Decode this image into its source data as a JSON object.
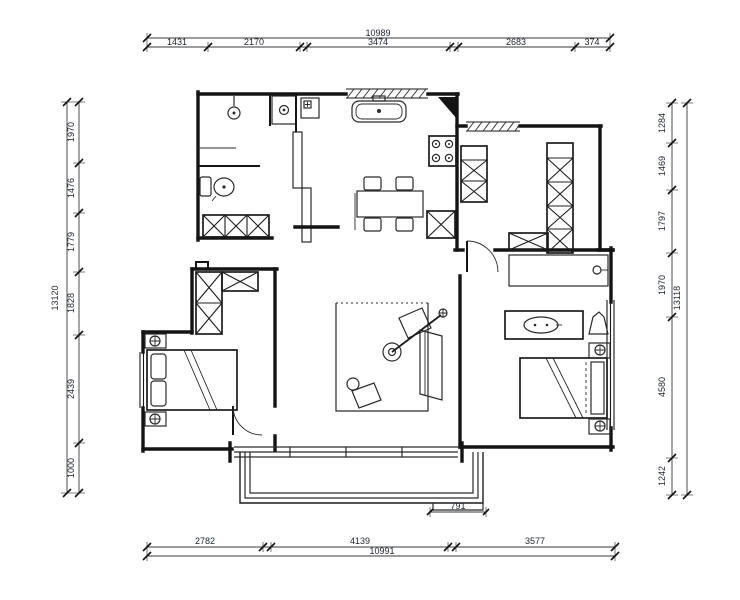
{
  "dimensions": {
    "top": {
      "total": "10989",
      "seg1": "1431",
      "seg2": "2170",
      "seg3": "3474",
      "seg4": "2683",
      "seg5": "374"
    },
    "bottom": {
      "total": "10991",
      "seg1": "2782",
      "seg2": "4139",
      "seg3": "3577"
    },
    "left": {
      "total": "13120",
      "seg1": "1970",
      "seg2": "1476",
      "seg3": "1779",
      "seg4": "1828",
      "seg5": "2439",
      "seg6": "1000"
    },
    "right": {
      "total": "13118",
      "seg1": "1284",
      "seg2": "1469",
      "seg3": "1797",
      "seg4": "1970",
      "seg5": "4580",
      "seg6": "1242"
    },
    "balcony_step": {
      "width": "791"
    }
  },
  "colors": {
    "wall": "#141414",
    "dim_line": "#3a3a3a",
    "dim_text": "#1c2430",
    "background": "#ffffff"
  }
}
